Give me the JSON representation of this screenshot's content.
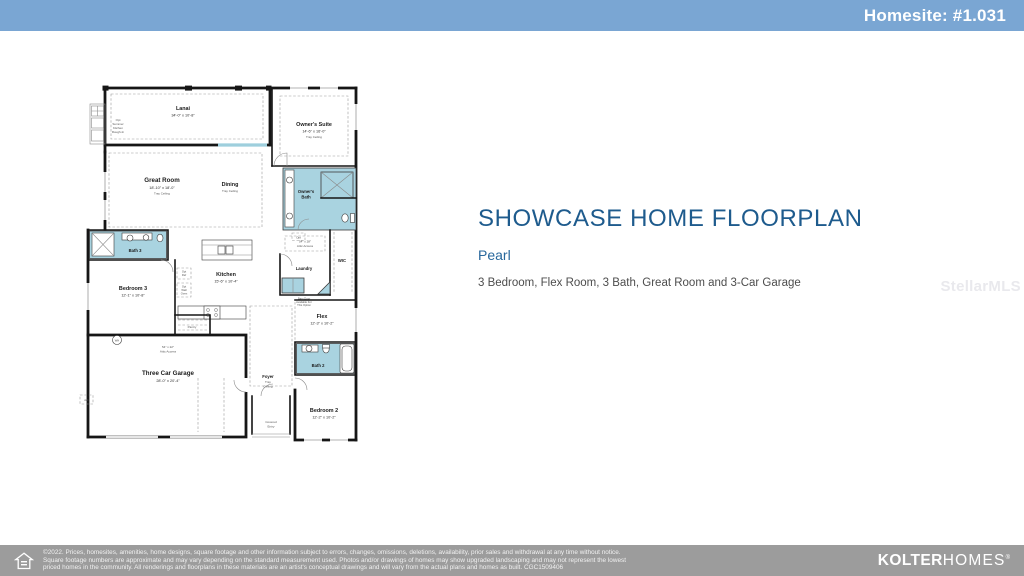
{
  "header": {
    "homesite_label": "Homesite: #1.031",
    "bar_color": "#7aa6d3"
  },
  "main": {
    "title": "SHOWCASE HOME FLOORPLAN",
    "plan_name": "Pearl",
    "description": "3 Bedroom, Flex Room, 3 Bath, Great Room and 3-Car Garage",
    "watermark": "StellarMLS"
  },
  "floorplan": {
    "rooms": {
      "lanai": {
        "name": "Lanai",
        "dims": "34'-0\" x 10'-8\""
      },
      "owners_suite": {
        "name": "Owner's Suite",
        "dims": "14'-6\" x 16'-0\"",
        "note": "Tray Ceiling"
      },
      "great_room": {
        "name": "Great Room",
        "dims": "18'-10\" x 18'-0\"",
        "note": "Tray Ceiling"
      },
      "dining": {
        "name": "Dining",
        "note": "Tray Ceiling"
      },
      "owners_bath": {
        "name_l1": "Owner's",
        "name_l2": "Bath"
      },
      "bath3": {
        "name": "Bath 3"
      },
      "kitchen": {
        "name": "Kitchen",
        "dims": "15'-6\" x 10'-4\""
      },
      "bedroom3": {
        "name": "Bedroom 3",
        "dims": "12'-1\" x 10'-8\""
      },
      "pantry": {
        "name": "Pantry"
      },
      "laundry": {
        "name": "Laundry"
      },
      "wic": {
        "name": "WIC"
      },
      "flex": {
        "name": "Flex",
        "dims": "12'-3\" x 10'-2\""
      },
      "garage": {
        "name": "Three Car Garage",
        "dims": "28'-0\" x 20'-4\""
      },
      "foyer": {
        "name": "Foyer",
        "note_l1": "Tray",
        "note_l2": "Ceiling"
      },
      "covered_entry": {
        "name_l1": "Covered",
        "name_l2": "Entry"
      },
      "bedroom2": {
        "name": "Bedroom 2",
        "dims": "12'-2\" x 10'-2\""
      },
      "bath2": {
        "name": "Bath 2"
      }
    },
    "notes": {
      "sk_l1": "Opt",
      "sk_l2": "Summer",
      "sk_l3": "Kitchen",
      "sk_l4": "Rough-In",
      "opt_ref_l1": "Opt",
      "opt_ref_l2": "Ref",
      "opt_oven_l1": "Opt",
      "opt_oven_l2": "Wall",
      "opt_oven_l3": "Oven",
      "attic_wic_l1": "54\" x 28\"",
      "attic_wic_l2": "Attic Access",
      "attic_garage_l1": "54\" x 22\"",
      "attic_garage_l2": "Attic Access",
      "barn_l1": "Barn Door",
      "barn_l2": "Available For",
      "barn_l3": "This Option",
      "wh": "WH",
      "ac": "A/C",
      "opt": "Opt"
    }
  },
  "footer": {
    "line1": "©2022. Prices, homesites, amenities, home designs, square footage and other information subject to errors, changes, omissions, deletions, availability, prior sales and withdrawal at any time without notice.",
    "line2": "Square footage numbers are approximate and may vary depending on the standard measurement used. Photos and/or drawings of homes may show upgraded landscaping and may not represent the lowest",
    "line3": "priced homes in the community. All renderings and floorplans in these materials are an artist's conceptual drawings and will vary from the actual plans and homes as built. CGC1509406",
    "brand_bold": "KOLTER",
    "brand_light": "HOMES",
    "brand_mark": "®"
  }
}
